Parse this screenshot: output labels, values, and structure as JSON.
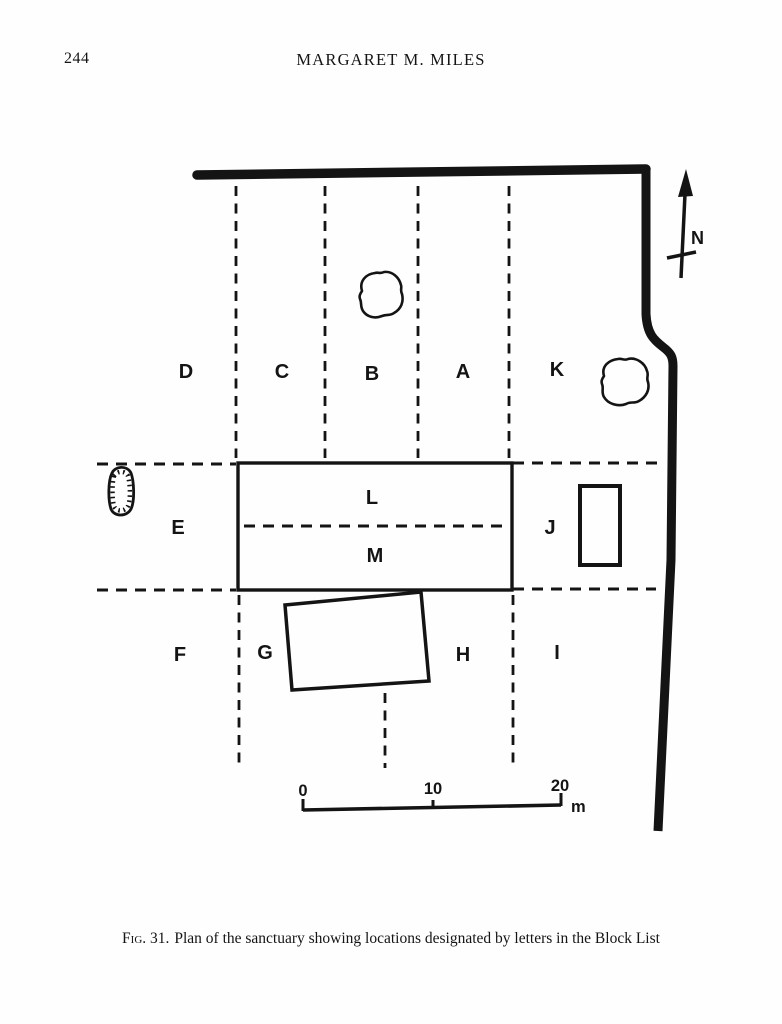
{
  "page": {
    "number": "244",
    "running_head": "MARGARET M. MILES"
  },
  "figure": {
    "caption_fig": "Fig. 31.",
    "caption_text": "Plan of the sanctuary showing locations designated by letters in the Block List",
    "north_label": "N",
    "scale_bar": {
      "tick_0": "0",
      "tick_10": "10",
      "tick_20": "20",
      "unit": "m"
    },
    "zones": {
      "A": "A",
      "B": "B",
      "C": "C",
      "D": "D",
      "E": "E",
      "F": "F",
      "G": "G",
      "H": "H",
      "I": "I",
      "J": "J",
      "K": "K",
      "L": "L",
      "M": "M"
    }
  },
  "colors": {
    "ink": "#141414",
    "paper": "#fefefe"
  }
}
